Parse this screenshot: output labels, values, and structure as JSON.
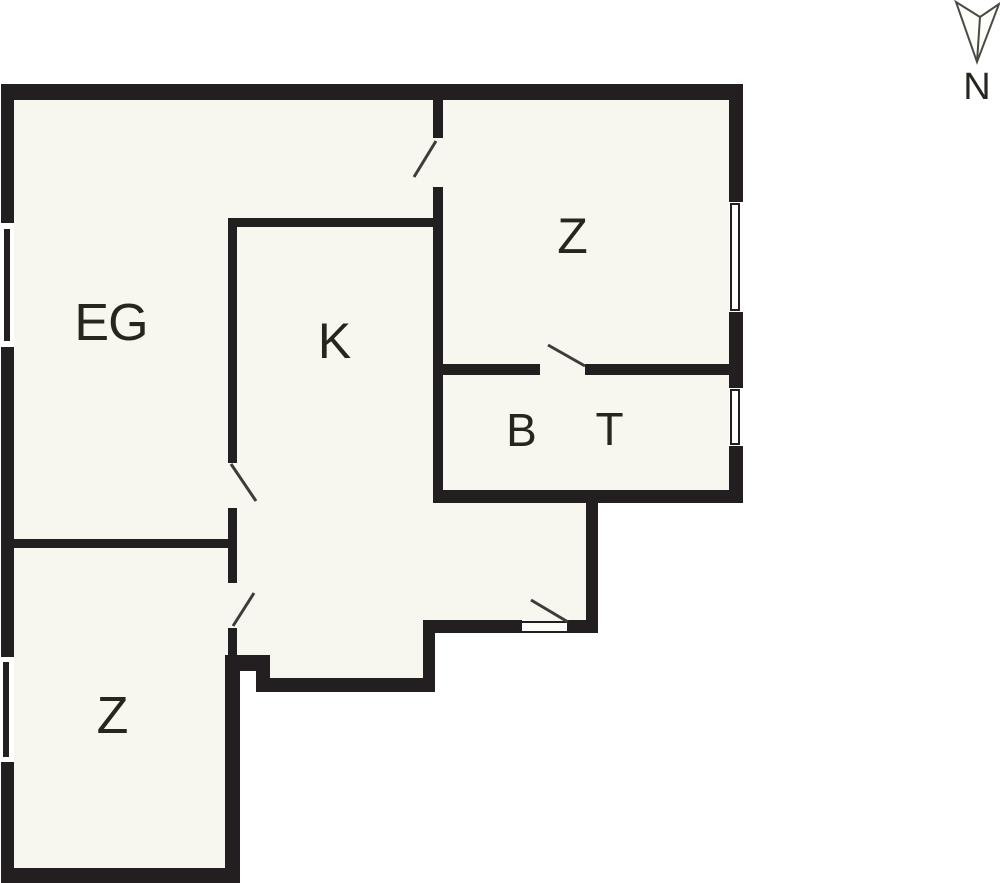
{
  "plan": {
    "type": "apartment-floor-plan",
    "rooms": [
      {
        "id": "eg",
        "label": "EG"
      },
      {
        "id": "k",
        "label": "K"
      },
      {
        "id": "z-top",
        "label": "Z"
      },
      {
        "id": "b",
        "label": "B"
      },
      {
        "id": "t",
        "label": "T"
      },
      {
        "id": "z-bottom",
        "label": "Z"
      }
    ]
  },
  "north": {
    "label": "N"
  },
  "colors": {
    "wall": "#231f20",
    "floor": "#f8f7ef",
    "outside": "#ffffff",
    "line": "#3f3c38",
    "text": "#28251f"
  }
}
